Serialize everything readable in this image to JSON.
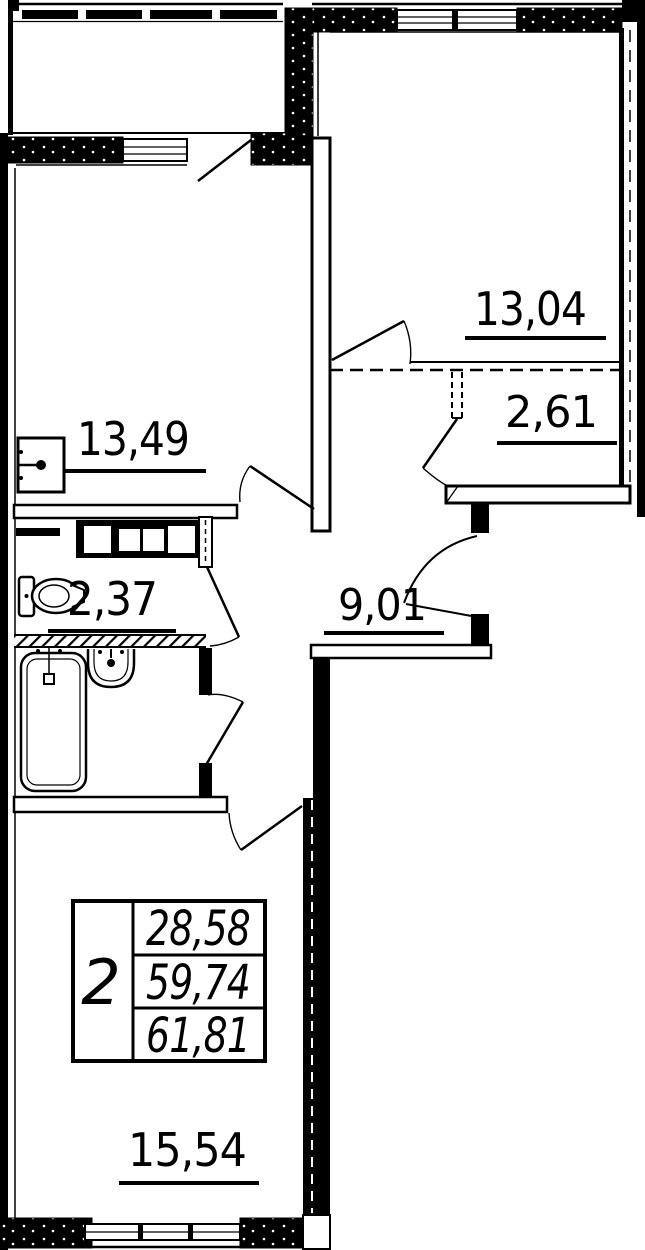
{
  "floor_plan": {
    "areas": {
      "bedroom": "13,04",
      "closet": "2,61",
      "kitchen": "13,49",
      "wc": "2,37",
      "hall": "9,01",
      "living": "15,54"
    },
    "info_table": {
      "rooms_count": "2",
      "area_values": [
        "28,58",
        "59,74",
        "61,81"
      ]
    },
    "colors": {
      "line": "#000000",
      "background": "#ffffff"
    }
  }
}
